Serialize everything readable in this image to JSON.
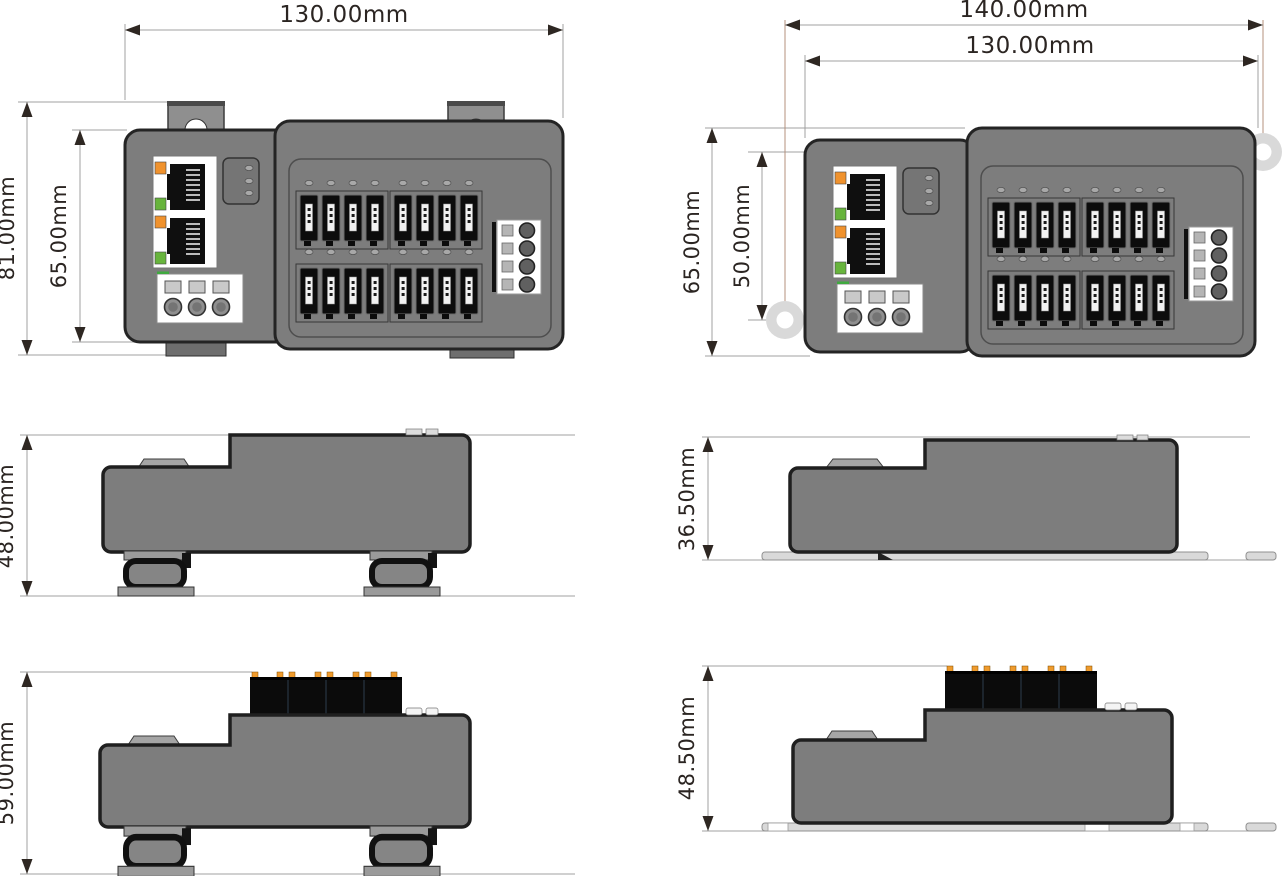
{
  "drawing": {
    "title": "device-dimension-drawing",
    "views": {
      "front_din": {
        "width_label": "130.00mm",
        "outer_height_label": "81.00mm",
        "inner_height_label": "65.00mm"
      },
      "front_wall": {
        "outer_width_label": "140.00mm",
        "inner_width_label": "130.00mm",
        "outer_height_label": "65.00mm",
        "inner_height_label": "50.00mm"
      },
      "side_din": {
        "height_label": "48.00mm"
      },
      "side_wall": {
        "height_label": "36.50mm"
      },
      "side_din_connectors": {
        "height_label": "59.00mm"
      },
      "side_wall_connectors": {
        "height_label": "48.50mm"
      }
    },
    "colors": {
      "body_gray": "#7d7d7d",
      "outline": "#242424",
      "led_orange": "#f0922d",
      "led_green": "#67b43c",
      "connector_black": "#0b0b0b",
      "mount_ear_gray": "#d9d9d9",
      "dimension_line_gray": "#a0a0a0",
      "dimension_line_tan": "#b5907c",
      "dimension_text": "#2b2522"
    }
  }
}
